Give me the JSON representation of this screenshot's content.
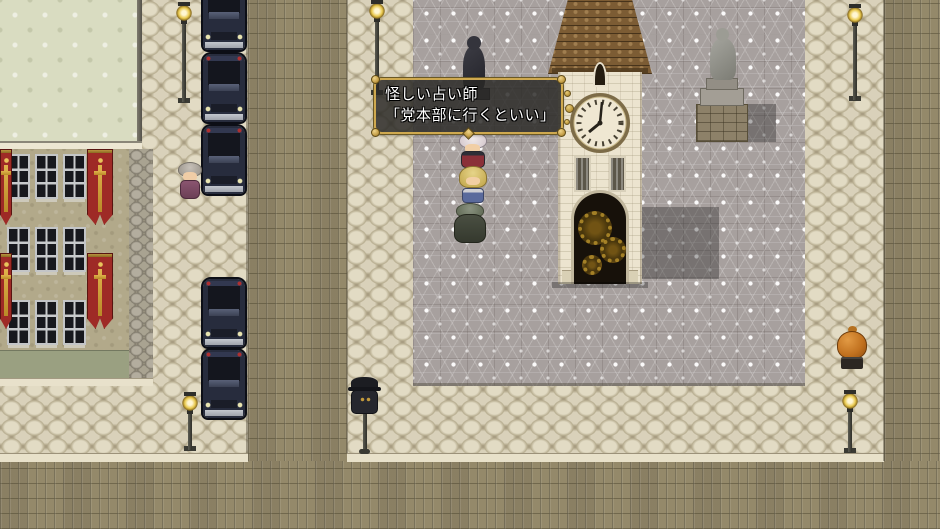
{
  "window": {
    "type": "rpg-game-viewport",
    "width": 940,
    "height": 529
  },
  "dialogue_box": {
    "line1": "怪しい占い師",
    "line2": "「党本部に行くといい」"
  },
  "scene_objects": [
    "clock-tower",
    "dark-statue",
    "gray-statue-on-brick-pedestal",
    "fortune-teller-npc",
    "party-member-blonde",
    "party-member-cloaked",
    "elderly-npc",
    "dark-coat-npc",
    "parked-vintage-cars",
    "street-lamps",
    "orange-pot",
    "building-with-red-sword-banners",
    "cobblestone-plaza",
    "ornate-gray-tile-plaza",
    "brick-roads"
  ],
  "palette": {
    "plaza_tile": "#a7a09e",
    "cobblestone": "#d9d1ba",
    "brick_road": "#94896a",
    "tower_wall": "#ece4cf",
    "roof_shingles": "#7c5c34",
    "banner_red": "#9e2a26",
    "dialogue_border_gold": "#cfa94f",
    "car_body": "#272c3d",
    "lamp_glow": "#e9c94e",
    "pot_orange": "#c87a28"
  }
}
